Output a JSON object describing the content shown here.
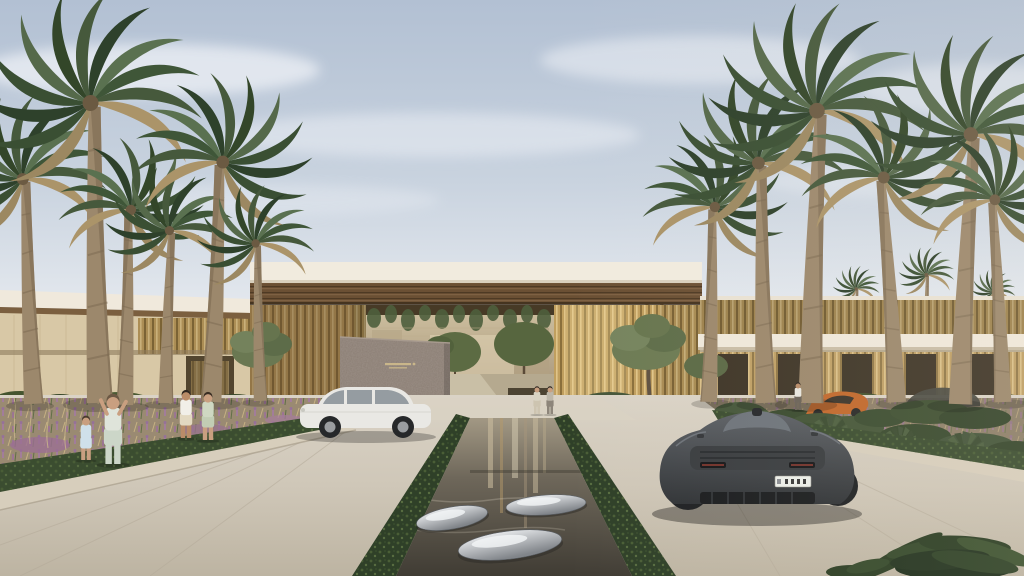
{
  "meta": {
    "title": "Photorealistic architectural rendering: luxury resort entrance with gold-louvered portal, palm-lined driveway, reflecting pool and supercars",
    "width": 1024,
    "height": 576
  },
  "palette": {
    "sky_top": "#b2c0d3",
    "sky_mid": "#c9d3df",
    "sky_horizon": "#eceff2",
    "cloud": "#eef1f6",
    "fascia_cream": "#f1ebde",
    "soffit_wood": "#6b5034",
    "soffit_wood_dark": "#4e3a24",
    "gold_louver": "#c09f5f",
    "gold_louver_dark": "#8a6f3c",
    "gold_louver_light": "#e0c488",
    "wall_beige": "#d8c8a6",
    "stone_wall": "#8b7e74",
    "sign_gold": "#c9b68a",
    "interior_back": "#cfc1a1",
    "pavement": "#d6cec0",
    "pavement_near": "#c0b7a6",
    "pool_water_deep": "#403c34",
    "pool_water_top": "#a29884",
    "pebble_metal": "#c9ccd0",
    "hedge_green": "#2f4028",
    "grass_tan": "#c8b283",
    "flower_purple": "#a27c9c",
    "flower_white": "#ece5d3",
    "palm_frond": "#3f5638",
    "palm_trunk": "#9c886c",
    "olive_tree": "#6a7852",
    "car_white": "#e9e8e4",
    "car_graphite": "#4b4e52",
    "car_orange": "#c1682c",
    "plate_white": "#eceee9"
  },
  "scene": {
    "sign": {
      "present": true,
      "legible": false,
      "label": "engraved brand logo on granite feature wall (characters illegible)"
    },
    "pool": {
      "label": "central reflecting pool flanked by clipped hedges",
      "sculptures": 3,
      "sculpture_label": "polished metal pebble sculptures"
    },
    "counts": {
      "palms_foreground": 12,
      "palms_background": 4,
      "people": 7,
      "vehicles": 4
    },
    "vehicles": [
      {
        "id": "white-car",
        "label": "white luxury car, side view, left driveway",
        "color": "#e9e8e4"
      },
      {
        "id": "dark-supercar",
        "label": "graphite supercar, rear view, right driveway; white licence plate, characters illegible",
        "color": "#4b4e52",
        "plate_legible": false
      },
      {
        "id": "orange-supercar",
        "label": "orange sports car partially hidden in right garden",
        "color": "#c1682c"
      },
      {
        "id": "hidden-dark-car",
        "label": "dark car behind shrubs far right",
        "color": "#4b4b42"
      }
    ],
    "people": [
      {
        "id": "child",
        "label": "girl in light blue dress",
        "x": 86,
        "y": 460,
        "h": 48,
        "skin": "#c99f80",
        "hair": "#4a3b2e",
        "top": "#cfe0ea",
        "bottom": "#cfe0ea",
        "legs": "#c99f80"
      },
      {
        "id": "woman-photographer",
        "label": "woman in mint outfit raising phone",
        "x": 113,
        "y": 464,
        "h": 76,
        "skin": "#c99f80",
        "hair": "#6b5844",
        "top": "#dfe4da",
        "bottom": "#ccd6c8",
        "legs": "#ccd6c8",
        "pose": "arms-up"
      },
      {
        "id": "man-white-shirt",
        "label": "man in white polo and shorts",
        "x": 186,
        "y": 438,
        "h": 52,
        "skin": "#b98c68",
        "hair": "#2e2620",
        "top": "#f1efe8",
        "bottom": "#e2d8c0",
        "legs": "#b98c68"
      },
      {
        "id": "woman-floral-dress",
        "label": "woman in floral dress",
        "x": 208,
        "y": 440,
        "h": 52,
        "skin": "#c99f80",
        "hair": "#3a2e24",
        "top": "#cfd8c2",
        "bottom": "#c2cdb4",
        "legs": "#c99f80"
      },
      {
        "id": "walker-1",
        "label": "visitor walking in portal plaza",
        "x": 537,
        "y": 414,
        "h": 30,
        "skin": "#c99f80",
        "hair": "#3a3029",
        "top": "#d9d3c3",
        "bottom": "#cdc4b0",
        "legs": "#cdc4b0"
      },
      {
        "id": "walker-2",
        "label": "visitor walking in portal plaza",
        "x": 550,
        "y": 414,
        "h": 30,
        "skin": "#c99f80",
        "hair": "#2c2620",
        "top": "#bdb7aa",
        "bottom": "#8d857a",
        "legs": "#8d857a"
      },
      {
        "id": "right-visitor",
        "label": "person standing in right garden",
        "x": 798,
        "y": 410,
        "h": 30,
        "skin": "#b98c68",
        "hair": "#2c2620",
        "top": "#e8e6df",
        "bottom": "#6a6258",
        "legs": "#6a6258"
      }
    ],
    "palms": {
      "foreground": [
        {
          "x": 30,
          "y": 404,
          "s": 1.5,
          "r": -3
        },
        {
          "x": 95,
          "y": 403,
          "s": 2.0,
          "r": -2
        },
        {
          "x": 128,
          "y": 405,
          "s": 1.3,
          "r": 2,
          "flip": true
        },
        {
          "x": 163,
          "y": 403,
          "s": 1.15,
          "r": 1
        },
        {
          "x": 215,
          "y": 402,
          "s": 1.6,
          "r": 3,
          "flip": true
        },
        {
          "x": 258,
          "y": 401,
          "s": 1.05,
          "r": -2
        },
        {
          "x": 712,
          "y": 402,
          "s": 1.3,
          "r": 2,
          "flip": true
        },
        {
          "x": 762,
          "y": 403,
          "s": 1.6,
          "r": -2
        },
        {
          "x": 806,
          "y": 403,
          "s": 1.95,
          "r": 1
        },
        {
          "x": 900,
          "y": 402,
          "s": 1.5,
          "r": -3,
          "flip": true
        },
        {
          "x": 956,
          "y": 404,
          "s": 1.8,
          "r": 2
        },
        {
          "x": 1006,
          "y": 402,
          "s": 1.35,
          "r": -2,
          "flip": true
        }
      ],
      "background": [
        {
          "x": 660,
          "y": 356,
          "s": 0.45
        },
        {
          "x": 855,
          "y": 352,
          "s": 0.42
        },
        {
          "x": 925,
          "y": 350,
          "s": 0.5
        },
        {
          "x": 992,
          "y": 352,
          "s": 0.4
        }
      ]
    }
  }
}
